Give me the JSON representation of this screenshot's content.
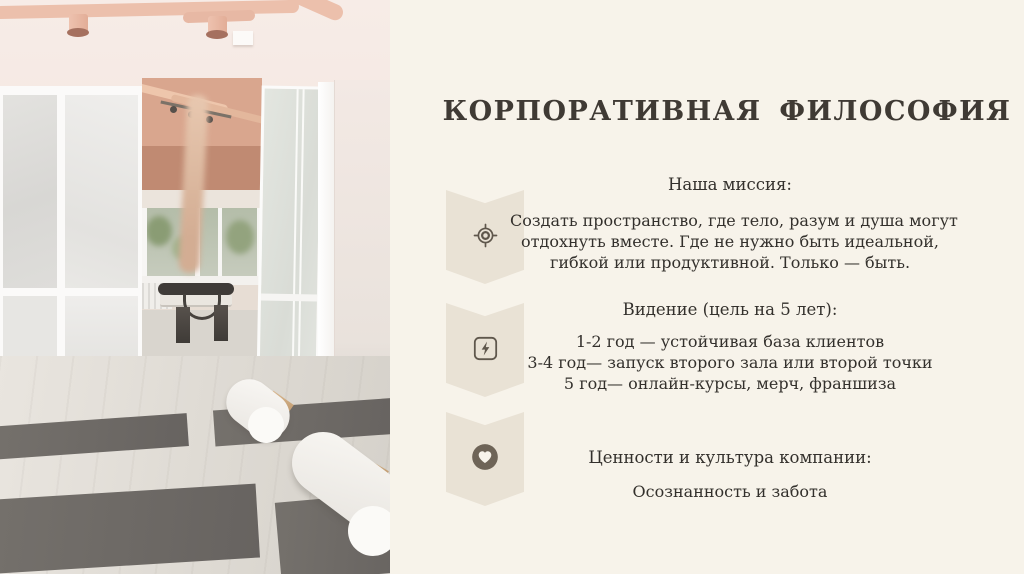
{
  "slide": {
    "title": "КОРПОРАТИВНАЯ  ФИЛОСОФИЯ",
    "sections": [
      {
        "icon": "target-icon",
        "heading": "Наша миссия:",
        "lines": [
          "Создать пространство, где тело, разум и душа могут",
          "отдохнуть вместе. Где не нужно быть идеальной,",
          "гибкой или продуктивной. Только — быть."
        ]
      },
      {
        "icon": "lightning-icon",
        "heading": "Видение (цель на 5 лет):",
        "lines": [
          "1-2 год — устойчивая база клиентов",
          "3-4 год— запуск второго зала или второй точки",
          "5 год— онлайн-курсы, мерч, франшиза"
        ]
      },
      {
        "icon": "heart-icon",
        "heading": "Ценности и культура компании:",
        "lines": [
          "Осознанность и забота"
        ]
      }
    ],
    "colors": {
      "background": "#f7f3ea",
      "badge": "#e9e2d5",
      "icon_stroke": "#5f574c",
      "heart_circle": "#6e6457",
      "title_text": "#3f3a34",
      "body_text": "#33302c"
    }
  }
}
